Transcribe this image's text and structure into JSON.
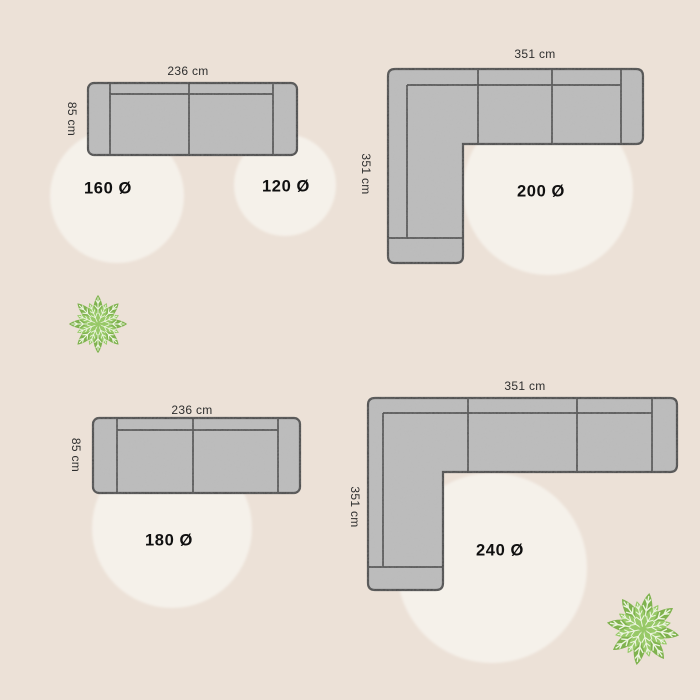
{
  "title": "Sofa and round rug size layout diagram",
  "colors": {
    "background": "#ece1d7",
    "rug_fill": "#f5f1ea",
    "sofa_fill": "#bdbdbd",
    "sofa_outline": "#474747",
    "dimension_text": "#2e2e2e",
    "rug_label_text": "#101010",
    "plant_dark_green": "#7fb24e",
    "plant_light_green": "#98c968"
  },
  "layouts": [
    {
      "sofa_type": "three-seat-sofa-top-view",
      "width_label": "236 cm",
      "depth_label": "85 cm",
      "rugs": [
        {
          "label": "160 Ø"
        },
        {
          "label": "120 Ø"
        }
      ]
    },
    {
      "sofa_type": "corner-sofa-top-view",
      "width_label": "351 cm",
      "depth_label": "351 cm",
      "rugs": [
        {
          "label": "200 Ø"
        }
      ]
    },
    {
      "sofa_type": "three-seat-sofa-top-view",
      "width_label": "236 cm",
      "depth_label": "85 cm",
      "rugs": [
        {
          "label": "180 Ø"
        }
      ]
    },
    {
      "sofa_type": "corner-sofa-top-view",
      "width_label": "351 cm",
      "depth_label": "351 cm",
      "rugs": [
        {
          "label": "240 Ø"
        }
      ]
    }
  ],
  "decor": [
    {
      "icon": "plant-top-view-icon",
      "position": "upper-left"
    },
    {
      "icon": "plant-top-view-icon",
      "position": "lower-right"
    }
  ]
}
